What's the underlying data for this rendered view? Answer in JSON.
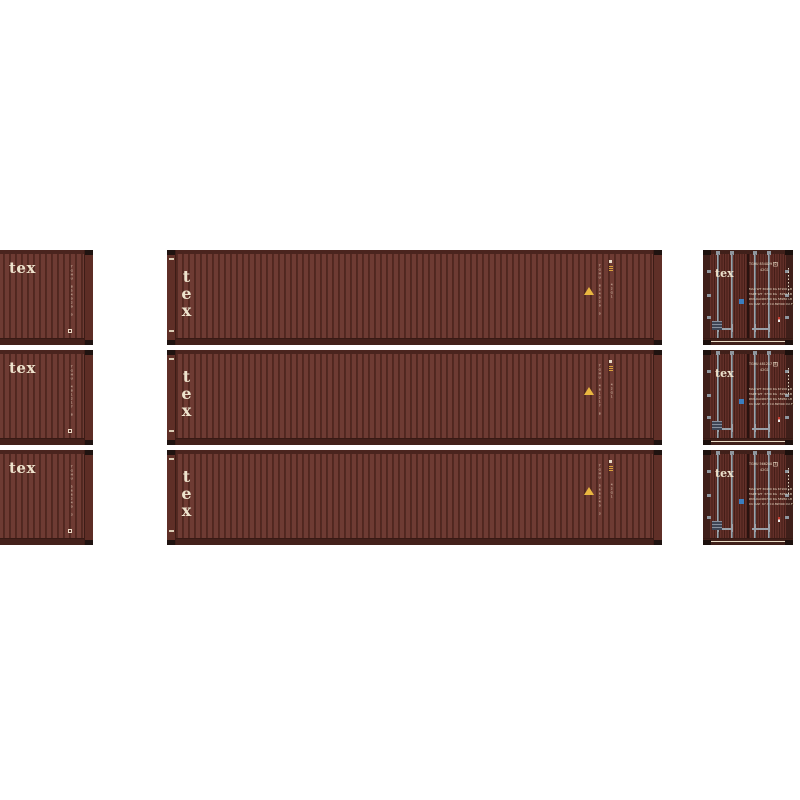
{
  "image": {
    "description": "Product photo: three brown TEX 40' corrugated shipping containers shown as cropped side view (left), full side view (center) and door-end view (right), stacked three high on a white background",
    "background_color": "#ffffff"
  },
  "logo": {
    "text": "tex"
  },
  "colors": {
    "body_brown": "#6e3b33",
    "rib_shadow": "#572a23",
    "rail_brown": "#44211b",
    "door_post_dark": "#3f1f1a",
    "cream_text": "#ede2cc",
    "lock_rod_gray": "#9ba3ab",
    "hardware_gray": "#8f969e",
    "sticker_blue": "#3b7ec0",
    "data_plate_navy": "#3e4555",
    "warning_yellow": "#e9b740",
    "gold_mark": "#d9a33c",
    "seal_red": "#c23b2e",
    "corner_casting_black": "#1f1310"
  },
  "rows": [
    {
      "number": "TGHU 854029",
      "check_digit": "0",
      "type_code": "42G1",
      "vertical_number": "TGHU 854029 0"
    },
    {
      "number": "TGHU 481217",
      "check_digit": "8",
      "type_code": "42G1",
      "vertical_number": "TGHU 481217 8"
    },
    {
      "number": "TGHU 566240",
      "check_digit": "3",
      "type_code": "42G1",
      "vertical_number": "TGHU 566240 3"
    }
  ],
  "door_specs": {
    "labels": [
      "MAX WT",
      "TARE WT",
      "PAYLOAD",
      "CU CAP"
    ],
    "metric": [
      "30480 KG",
      "3740 KG",
      "26740 KG",
      "67.7 CU.M"
    ],
    "imperial": [
      "67200 LB",
      "8250 LB",
      "58950 LB",
      "2390 CU.FT"
    ]
  }
}
